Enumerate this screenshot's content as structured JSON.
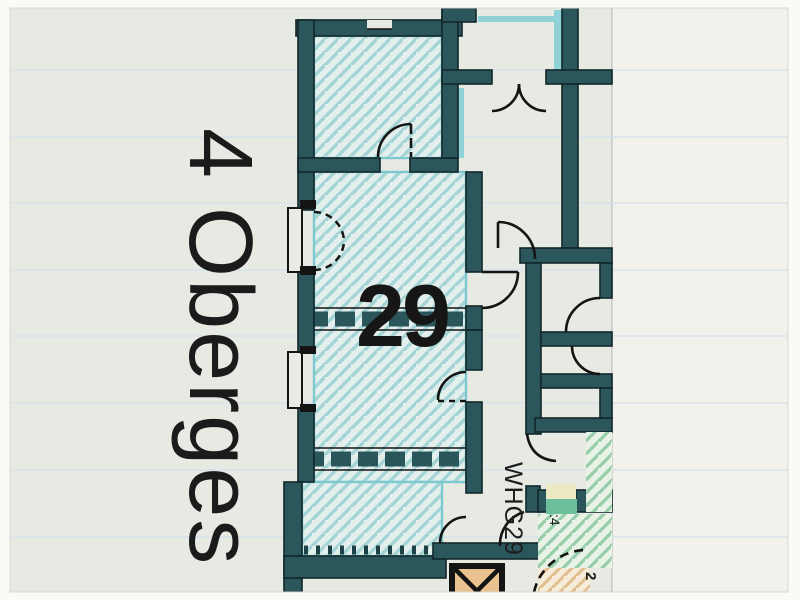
{
  "floor_plan": {
    "side_label": "4 Oberges",
    "room_number": "29",
    "apartment_label": "WHG29",
    "stair_annotation": ":4",
    "corner_annotation": "2",
    "symbols": {
      "elevator": "elevator-x-symbol",
      "doors": "quarter-circle-door-swing",
      "windows": "dashed-casement-arcs"
    },
    "colors": {
      "wall": "#2b565b",
      "hatch_line": "#a5d4d6",
      "hatch_bg": "#e2efec",
      "hatch_edge": "#7cc9cf",
      "highlight_cyan": "#8fd3d8",
      "door_highlight_green": "#6cbf9b",
      "door_highlight_yellow": "#ebeac2",
      "stair_hatch_green": "#97cda8",
      "stair_hatch_bg": "#e9f2e7",
      "elevator_fill": "#e9c28f",
      "shaft_hatch_orange": "#e2bd8e",
      "paper": "#e7e9e3",
      "paper_margin": "#f2f1eb",
      "line_black": "#141414"
    }
  }
}
